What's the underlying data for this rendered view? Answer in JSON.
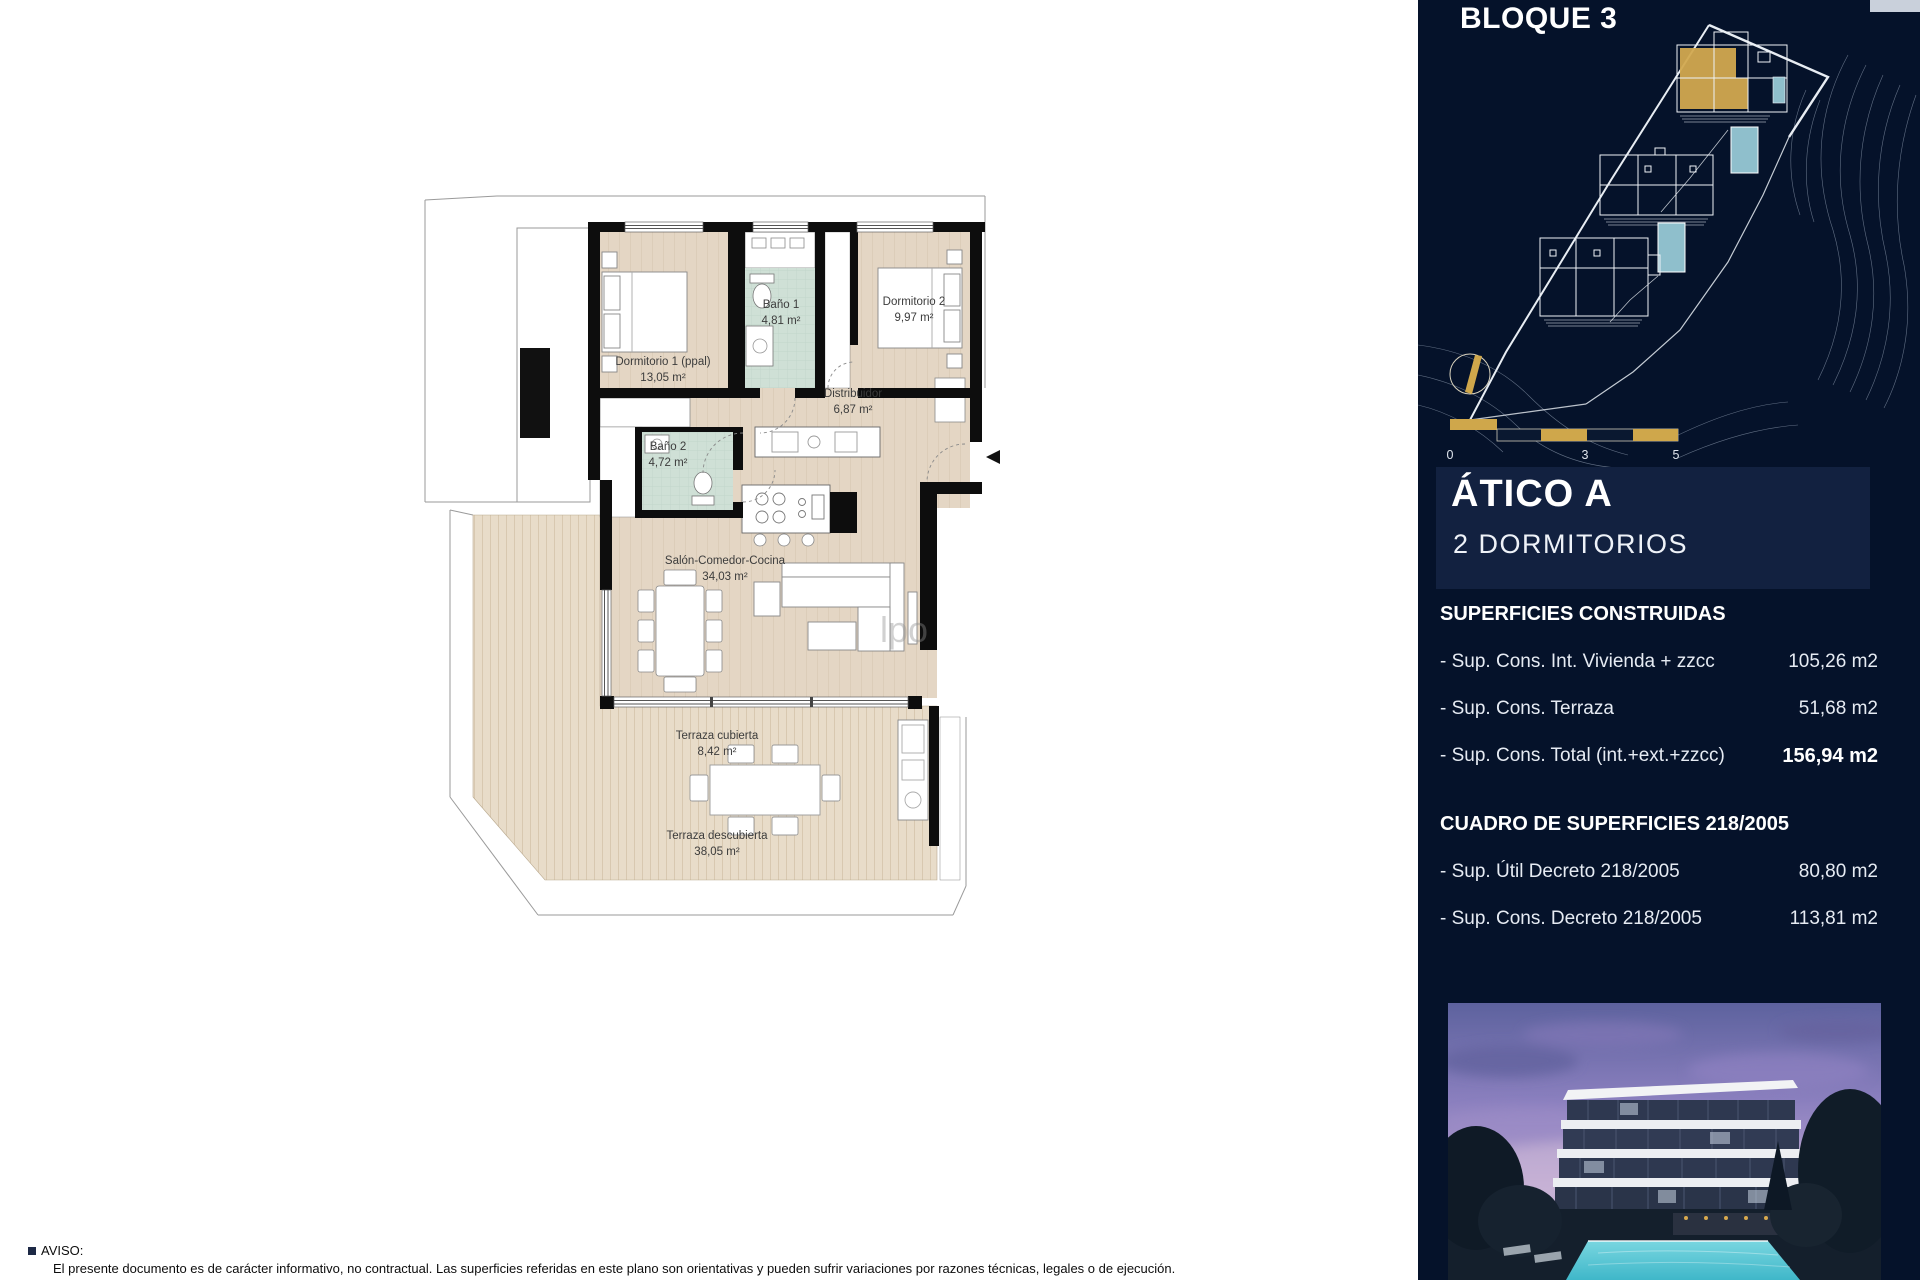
{
  "sidebar": {
    "block_title": "BLOQUE 3",
    "scalebar": {
      "t0": "0",
      "t3": "3",
      "t5": "5"
    },
    "unit": {
      "title": "ÁTICO A",
      "subtitle": "2 DORMITORIOS"
    },
    "superficies": {
      "heading": "SUPERFICIES CONSTRUIDAS",
      "rows": [
        {
          "label": "- Sup. Cons. Int. Vivienda + zzcc",
          "value": "105,26 m2"
        },
        {
          "label": "- Sup. Cons. Terraza",
          "value": "51,68 m2"
        },
        {
          "label": "- Sup. Cons. Total (int.+ext.+zzcc)",
          "value": "156,94 m2"
        }
      ]
    },
    "cuadro": {
      "heading": "CUADRO DE SUPERFICIES 218/2005",
      "rows": [
        {
          "label": "- Sup. Útil Decreto 218/2005",
          "value": "80,80 m2"
        },
        {
          "label": "- Sup. Cons. Decreto 218/2005",
          "value": "113,81 m2"
        }
      ]
    }
  },
  "plan": {
    "rooms": [
      {
        "name": "Dormitorio 1 (ppal)",
        "area": "13,05 m²"
      },
      {
        "name": "Baño 1",
        "area": "4,81 m²"
      },
      {
        "name": "Dormitorio 2",
        "area": "9,97 m²"
      },
      {
        "name": "Distribuidor",
        "area": "6,87 m²"
      },
      {
        "name": "Baño 2",
        "area": "4,72 m²"
      },
      {
        "name": "Salón-Comedor-Cocina",
        "area": "34,03 m²"
      },
      {
        "name": "Terraza cubierta",
        "area": "8,42 m²"
      },
      {
        "name": "Terraza descubierta",
        "area": "38,05 m²"
      }
    ],
    "watermark": "lpo"
  },
  "footer": {
    "aviso_title": "AVISO:",
    "aviso_text": "El presente documento es de carácter informativo, no contractual. Las superficies referidas en este plano son orientativas y pueden sufrir variaciones por razones técnicas, legales o de ejecución."
  },
  "colors": {
    "sidebar_bg": "#05122a",
    "panel_bg": "#122140",
    "gold": "#cfa74b",
    "pool": "#8fbfcc",
    "floor_beige": "#e4d6c4",
    "bath_teal": "#cfe0d6"
  }
}
